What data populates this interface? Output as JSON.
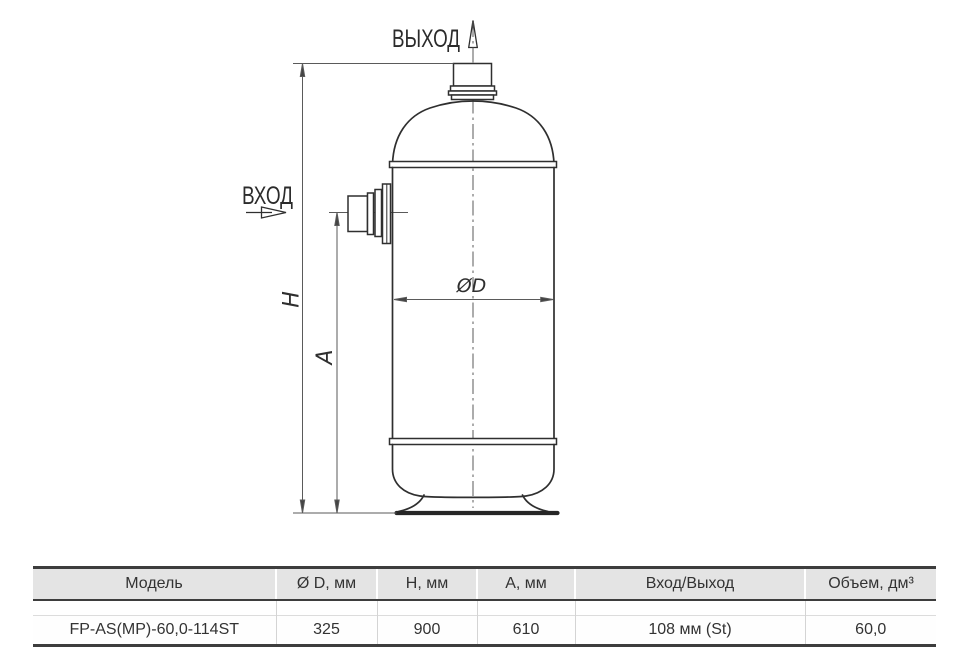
{
  "drawing": {
    "outlet_label": "ВЫХОД",
    "inlet_label": "ВХОД",
    "dim_height_label": "H",
    "dim_a_label": "A",
    "dim_diameter_label": "ØD"
  },
  "table": {
    "headers": [
      "Модель",
      "Ø D, мм",
      "H, мм",
      "A, мм",
      "Вход/Выход",
      "Объем, дм³"
    ],
    "rows": [
      [
        "FP-AS(MP)-60,0-114ST",
        "325",
        "900",
        "610",
        "108 мм (St)",
        "60,0"
      ]
    ]
  },
  "colors": {
    "vessel_line": "#2f2f2f",
    "dimension_line": "#5a5a5a",
    "table_border": "#3d3d3d",
    "table_header_bg": "#e4e4e4",
    "text": "#333333"
  }
}
